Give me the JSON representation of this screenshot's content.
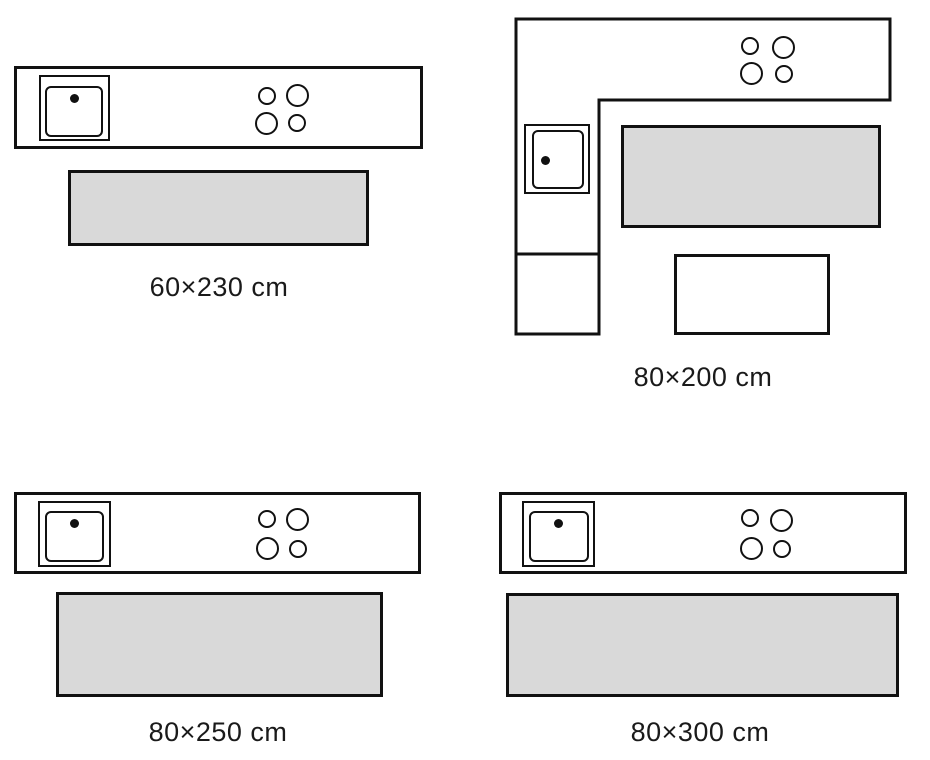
{
  "title": "Kitchen runner rug size diagrams",
  "colors": {
    "outline": "#111111",
    "rug_fill": "#d9d9d9",
    "background": "#ffffff",
    "text": "#1a1a1a"
  },
  "diagrams": [
    {
      "label": "60×230 cm",
      "layout": "straight-counter",
      "burner_count": 4,
      "has_sink": true,
      "rugs": [
        "gray"
      ]
    },
    {
      "label": "80×200 cm",
      "layout": "l-shaped-counter",
      "burner_count": 4,
      "has_sink": true,
      "rugs": [
        "gray",
        "white"
      ]
    },
    {
      "label": "80×250 cm",
      "layout": "straight-counter",
      "burner_count": 4,
      "has_sink": true,
      "rugs": [
        "gray"
      ]
    },
    {
      "label": "80×300 cm",
      "layout": "straight-counter",
      "burner_count": 4,
      "has_sink": true,
      "rugs": [
        "gray"
      ]
    }
  ]
}
